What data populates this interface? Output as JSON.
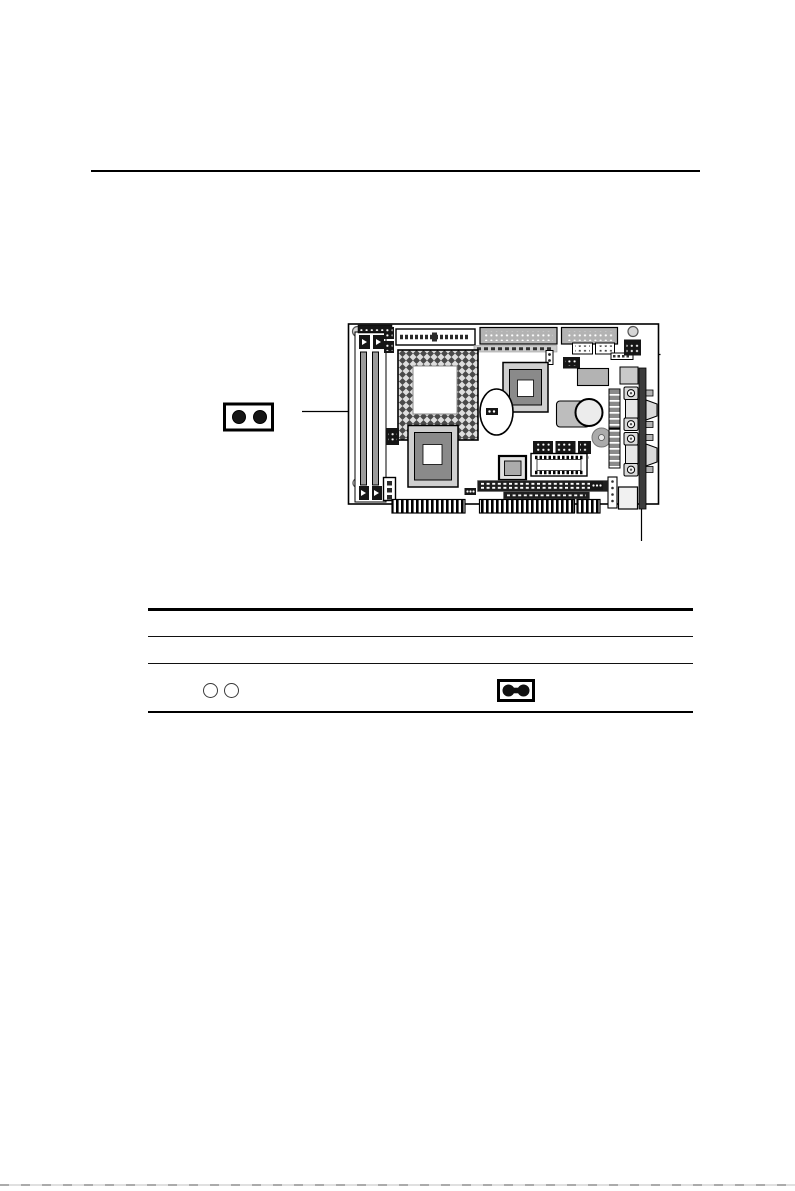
{
  "document": {
    "kind": "hardware-manual-page",
    "visible_text": [],
    "notes": "page contains only graphics: a board diagram figure with a 2-pin jumper callout, leader lines, and a 3-row ruled table whose only visible cells are jumper-state icons"
  },
  "colors": {
    "page_background": "#ffffff",
    "line_black": "#000000",
    "connector_gray": "#b3b3b3",
    "chip_outer_gray": "#cfcfcf",
    "chip_inner_gray": "#8a8a8a",
    "slot_bar_gray": "#9a9a9a",
    "bracket_dark": "#3c3c3c",
    "pin_block_dark": "#161616",
    "battery_gray": "#bdbdbd",
    "page_edge_artifact": "#8f8f8f"
  },
  "icons": {
    "callout_jumper": "jumper-2pin-filled-icon",
    "table_open_jumper": "jumper-2pin-open-icon",
    "table_closed_jumper": "jumper-2pin-capped-icon",
    "board": "single-board-computer-top-view-diagram"
  },
  "figure": {
    "callout": {
      "pins": 2,
      "points_to": "jumper area left of CPU socket"
    },
    "leaders": [
      "top-right bracket leader",
      "bottom-right bracket leader"
    ]
  },
  "table": {
    "horizontal_rules": 4,
    "rows": [
      {
        "left_cell_icon": "jumper-2pin-open-icon",
        "right_cell_icon": "jumper-2pin-capped-icon"
      }
    ]
  }
}
